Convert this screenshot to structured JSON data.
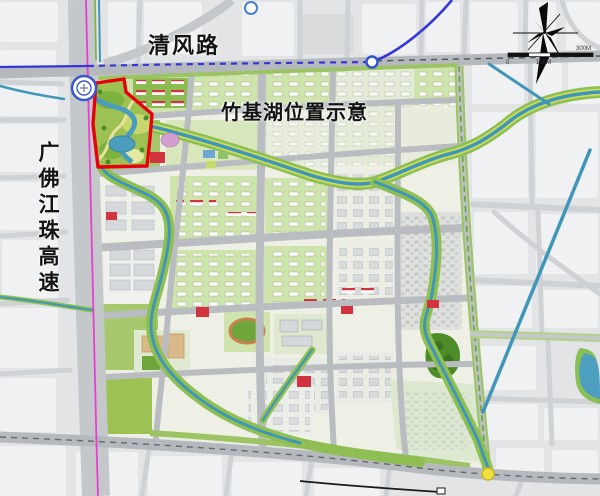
{
  "page": {
    "kind": "urban-planning-map",
    "subject": "竹基湖位置示意"
  },
  "labels": {
    "road_top": "清风路",
    "caption": "竹基湖位置示意",
    "expressway": "广佛江珠高速"
  },
  "scale_bar": {
    "zero": "0",
    "mid": "150M",
    "end": "300M"
  },
  "icons": {
    "compass": "wind-rose-north-arrow",
    "interchange": "expressway-interchange",
    "station": "metro-station-node",
    "junction": "road-junction-node"
  },
  "colors": {
    "boundary_red": "#e8000d",
    "water_teal": "#4a9dbd",
    "park_green": "#7fb241",
    "light_green_block": "#cfe3ad",
    "road_gray": "#b9bdc1",
    "metro_blue": "#3636d8",
    "rail_magenta": "#e83fd0",
    "junction_yellow": "#f2e13d",
    "background": "#e2e4e6"
  }
}
